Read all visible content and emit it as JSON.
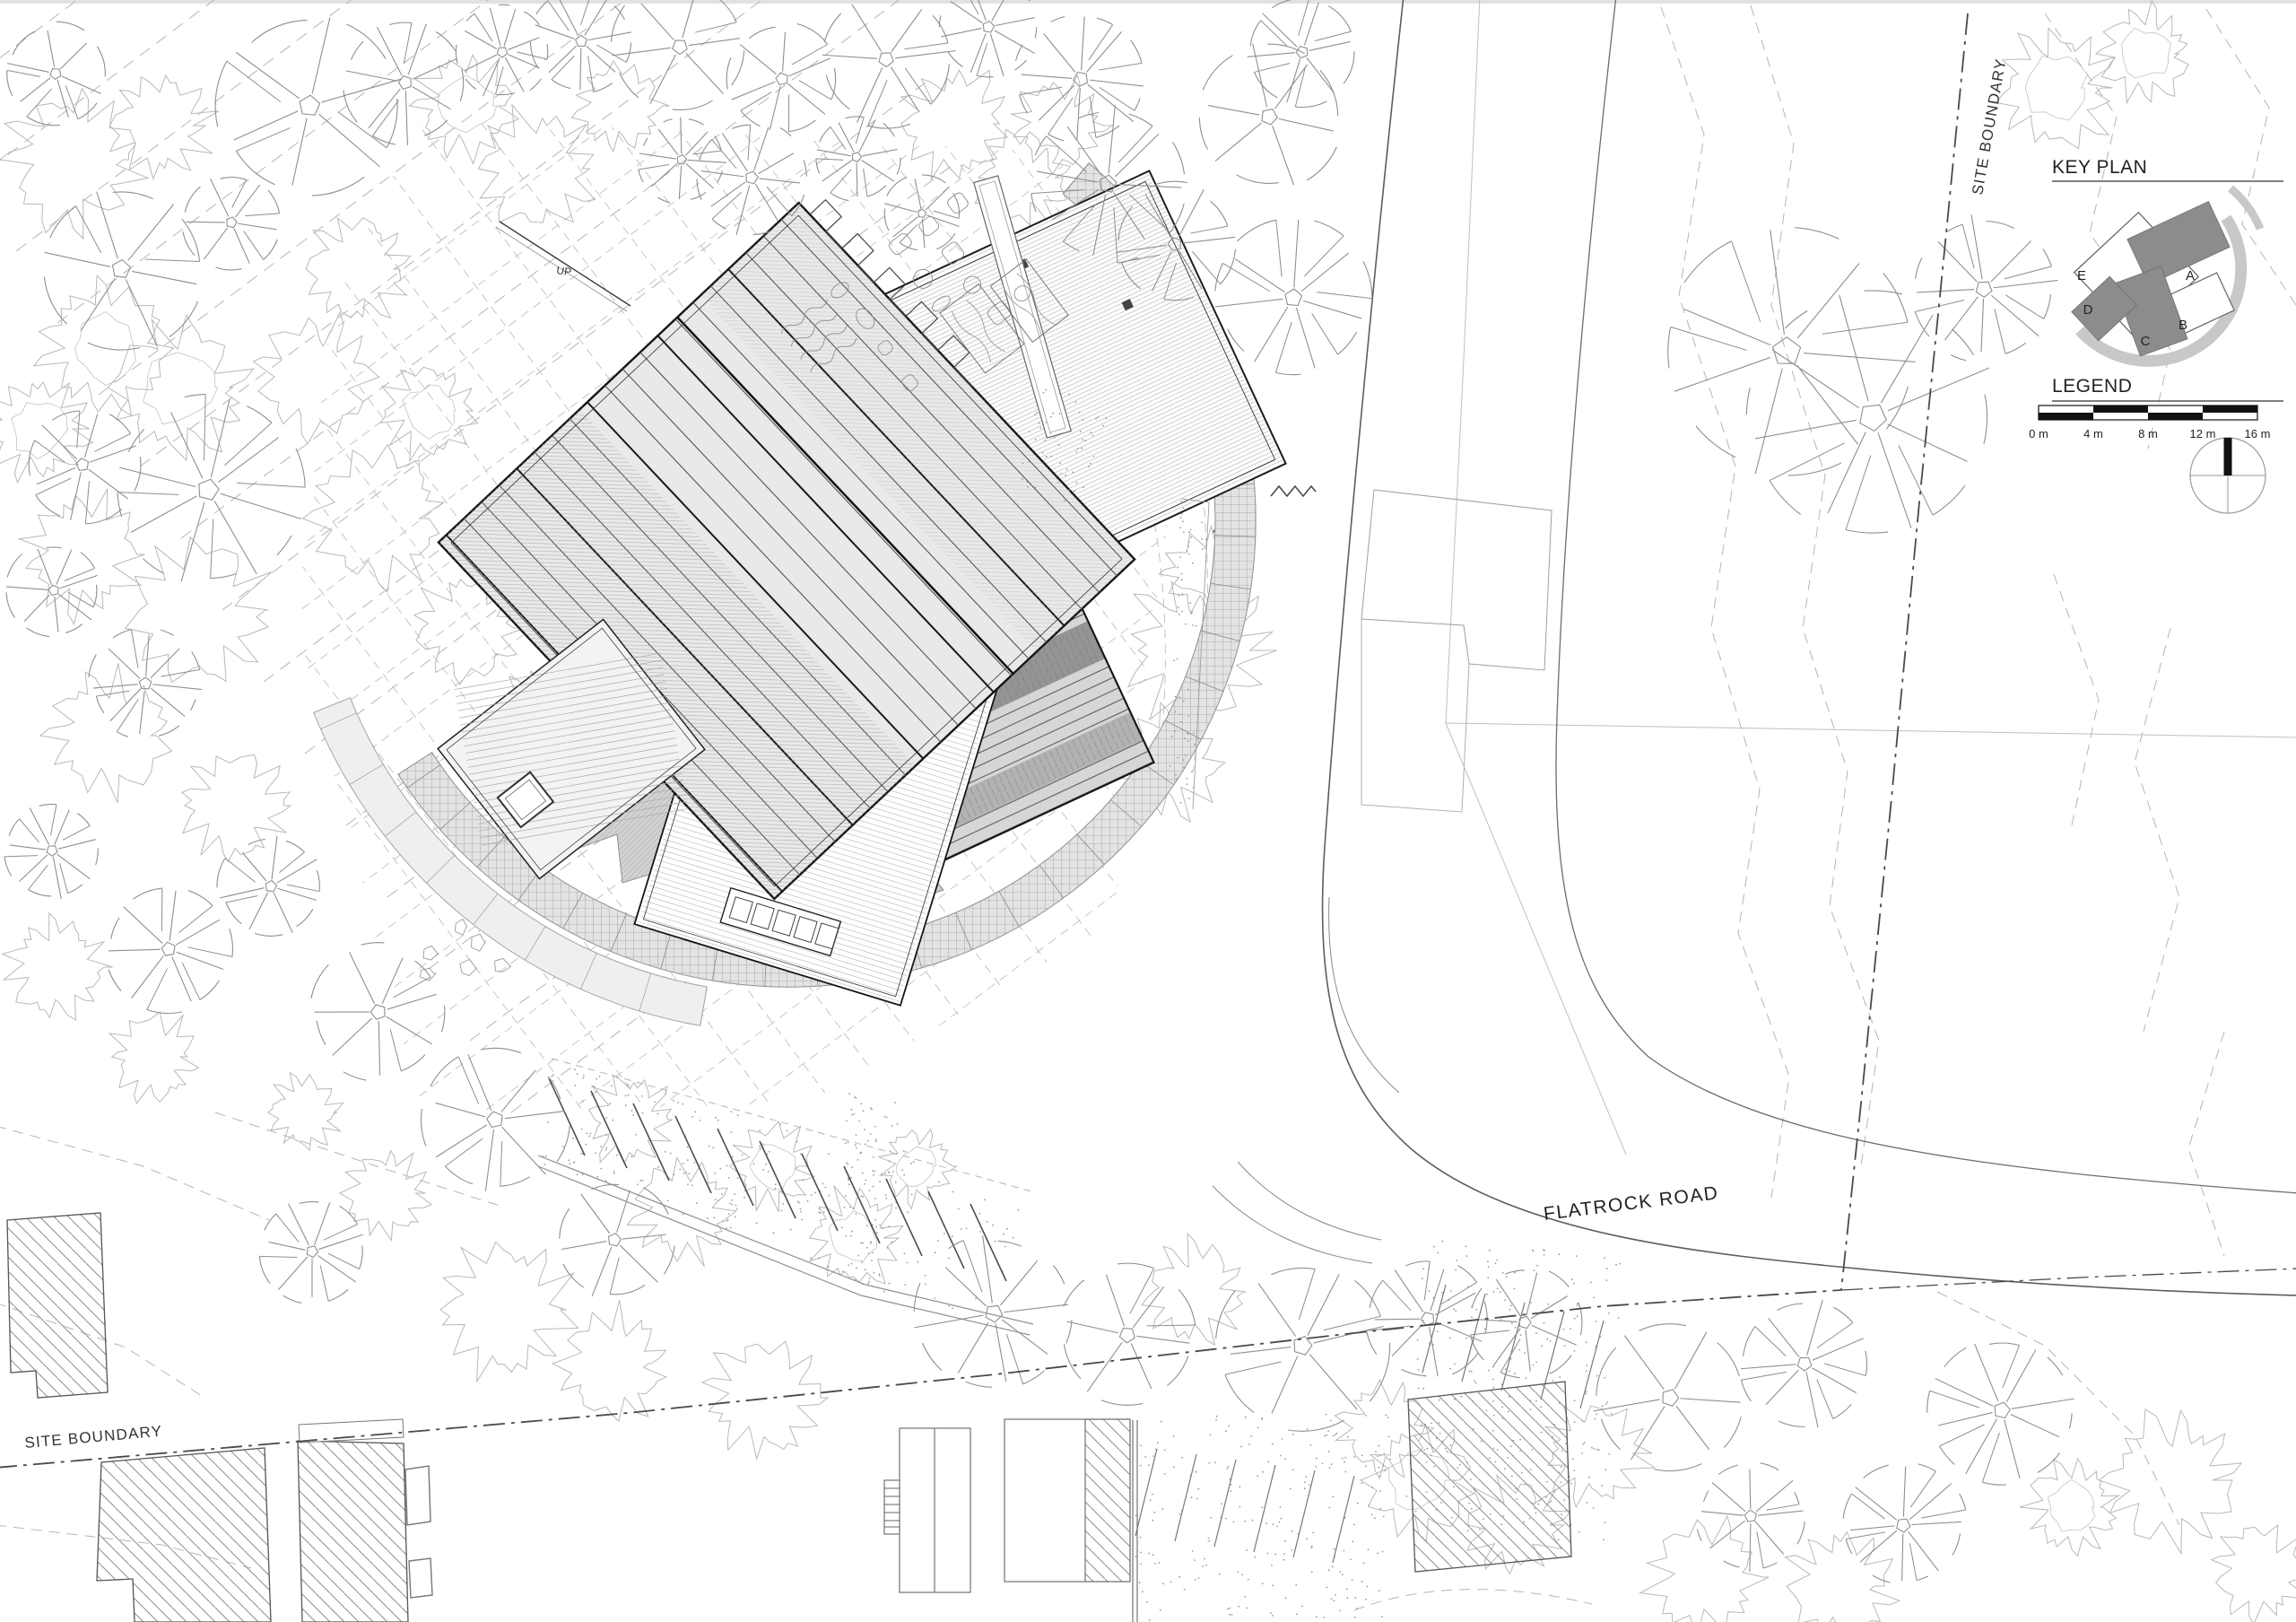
{
  "labels": {
    "site_boundary_top_right": "SITE BOUNDARY",
    "site_boundary_bottom_left": "SITE BOUNDARY",
    "road_name": "FLATROCK ROAD",
    "stairs": "UP"
  },
  "key_plan": {
    "title": "KEY PLAN",
    "building_labels": [
      "A",
      "B",
      "C",
      "D",
      "E"
    ]
  },
  "legend": {
    "title": "LEGEND",
    "scale_bar": {
      "tick_labels": [
        "0 m",
        "4 m",
        "8 m",
        "12 m",
        "16 m"
      ]
    }
  },
  "colors": {
    "paper": "#ffffff",
    "ink": "#1c1c1c",
    "light_line": "#b9b9b9",
    "tree_line": "#8f8f8f",
    "roof_dark_fill": "#8c8c8c",
    "terrace_fill": "#dedede",
    "keyplan_arc": "#c8c8c8"
  }
}
